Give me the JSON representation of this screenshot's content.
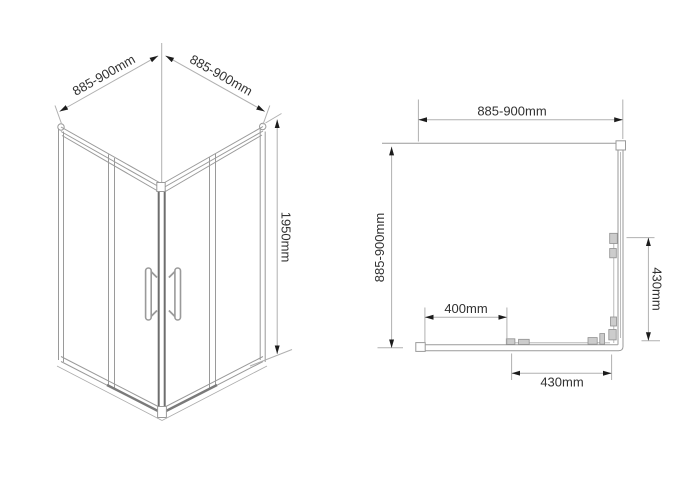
{
  "drawing": {
    "title": "corner shower enclosure dimension drawing",
    "background": "#ffffff",
    "line_color": "#9a9a9a",
    "dim_line_color": "#b0b0b0",
    "arrow_color": "#1c1c1c",
    "text_color": "#313131",
    "isometric_view": {
      "width_left_label": "885-900mm",
      "width_right_label": "885-900mm",
      "height_label": "1950mm"
    },
    "plan_view": {
      "width_label": "885-900mm",
      "depth_label": "885-900mm",
      "opening_label": "400mm",
      "side_door_label": "430mm",
      "front_door_label": "430mm"
    }
  }
}
